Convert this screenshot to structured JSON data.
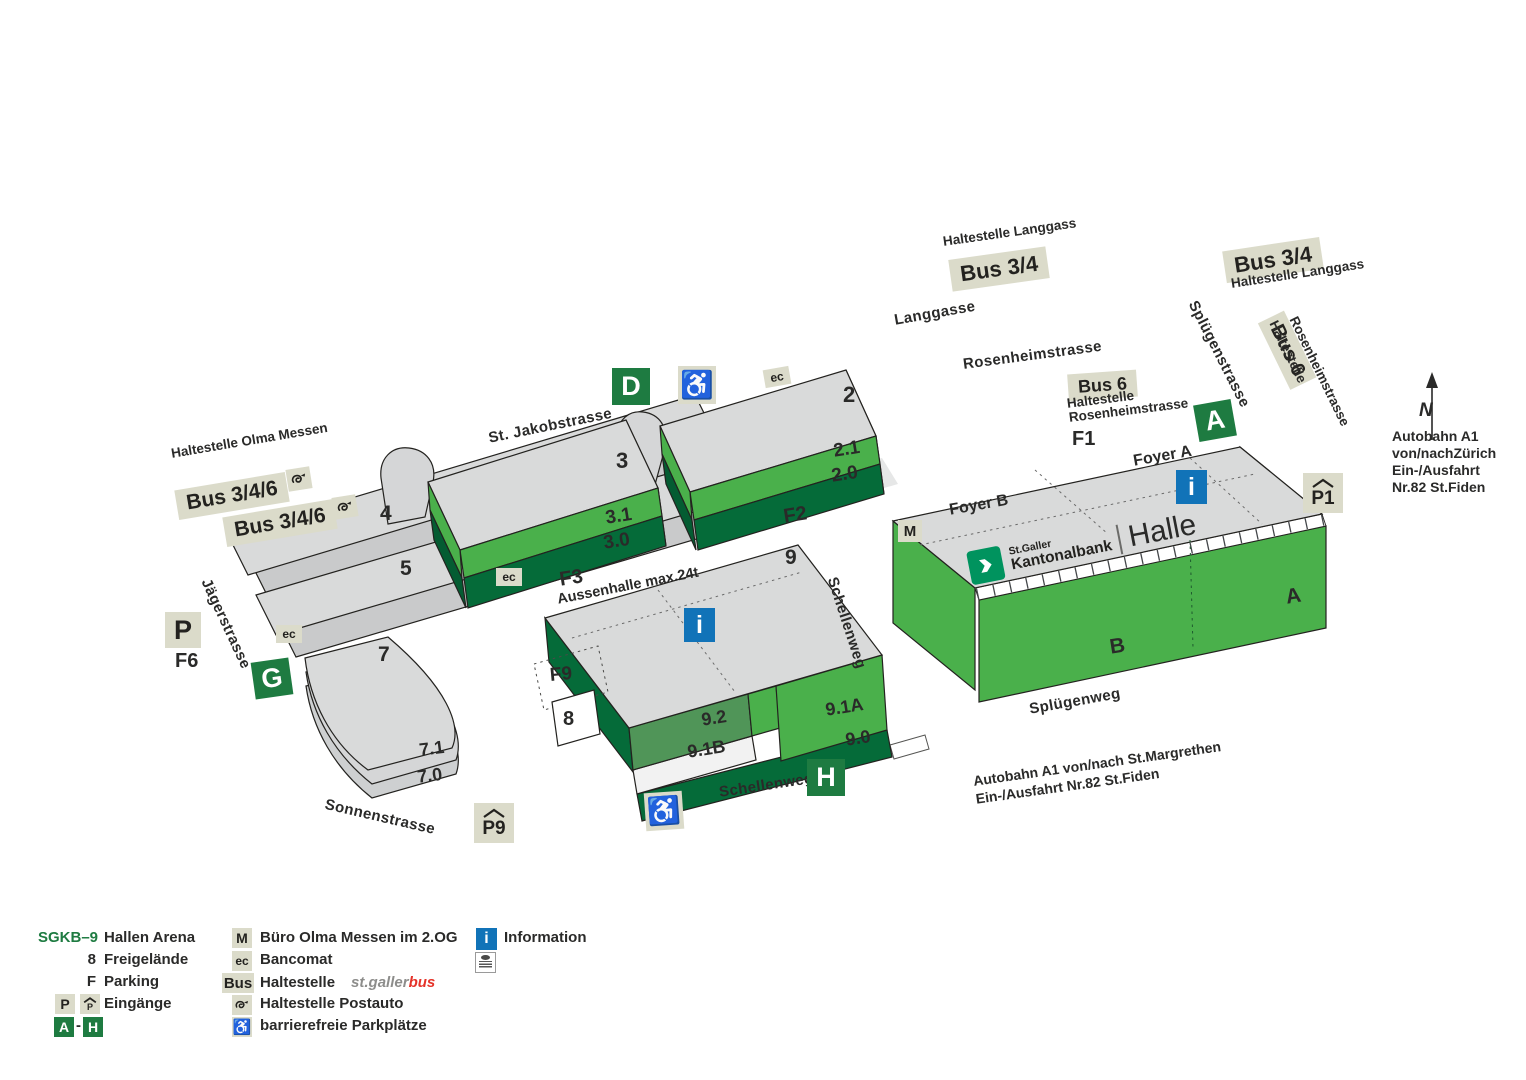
{
  "entrances": {
    "a": "A",
    "d": "D",
    "g": "G",
    "h": "H",
    "dash": "-"
  },
  "info": {
    "i": "i",
    "m": "M",
    "ec": "ec",
    "p": "P",
    "p1": "P1",
    "p9": "P9"
  },
  "transit": {
    "bus": "Bus",
    "bus34": "Bus 3/4",
    "bus6": "Bus 6",
    "bus346": "Bus 3/4/6",
    "stop_langgass": "Haltestelle Langgass",
    "stop_haltestelle": "Haltestelle",
    "stop_rosenheim": "Rosenheimstrasse",
    "stop_olma": "Haltestelle Olma Messen"
  },
  "streets": {
    "langgasse": "Langgasse",
    "rosenheimstrasse": "Rosenheimstrasse",
    "spluegenstrasse": "Splügenstrasse",
    "jakobstrasse": "St. Jakobstrasse",
    "jaegerstrasse": "Jägerstrasse",
    "sonnenstrasse": "Sonnenstrasse",
    "schellenweg": "Schellenweg",
    "spluegenweg": "Splügenweg"
  },
  "areas": {
    "f1": "F1",
    "f2": "F2",
    "f3": "F3",
    "f6": "F6",
    "f9": "F9",
    "aussenhalle": "Aussenhalle max.24t",
    "foyer_a": "Foyer A",
    "foyer_b": "Foyer B"
  },
  "halls": {
    "h2": "2",
    "h21": "2.1",
    "h20": "2.0",
    "h3": "3",
    "h31": "3.1",
    "h30": "3.0",
    "h4": "4",
    "h5": "5",
    "h7": "7",
    "h71": "7.1",
    "h70": "7.0",
    "h8": "8",
    "h9": "9",
    "h92": "9.2",
    "h91a": "9.1A",
    "h91b": "9.1B",
    "h90": "9.0",
    "ha": "A",
    "hb": "B"
  },
  "logo": {
    "top": "St.Galler",
    "bottom": "Kantonalbank",
    "hall": "Halle"
  },
  "compass": {
    "n": "N"
  },
  "notes": {
    "az1": "Autobahn A1",
    "az2": "von/nachZürich",
    "az3": "Ein-/Ausfahrt",
    "az4": "Nr.82 St.Fiden",
    "am1": "Autobahn A1 von/nach St.Margrethen",
    "am2": "Ein-/Ausfahrt Nr.82 St.Fiden"
  },
  "legend": {
    "sgkb9": "SGKB–9",
    "hallen_arena": "Hallen Arena",
    "n8": "8",
    "freigelaende": "Freigelände",
    "f": "F",
    "parking": "Parking",
    "eingaenge": "Eingänge",
    "buero": "Büro Olma Messen im 2.OG",
    "bancomat": "Bancomat",
    "haltestelle": "Haltestelle",
    "stgaller": "st.galler",
    "bus_red": "bus",
    "postauto": "Haltestelle Postauto",
    "barrierefrei": "barrierefreie Parkplätze",
    "information": "Information"
  },
  "colors": {
    "bright_green": "#4ab04b",
    "mid_green": "#509558",
    "dark_green": "#056b39",
    "badge_green": "#1e7b41",
    "badge_beige": "#dbdbca",
    "info_blue": "#1173b8",
    "sgkb_teal": "#00935e",
    "bus_red": "#e53329",
    "building_gray": "#d9dada"
  }
}
